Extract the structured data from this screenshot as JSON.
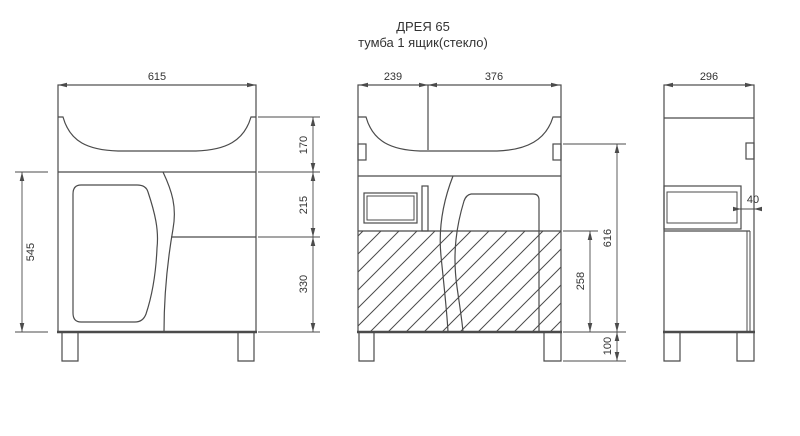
{
  "title": "ДРЕЯ 65",
  "subtitle": "тумба 1 ящик(стекло)",
  "colors": {
    "line": "#4b4b4b",
    "text": "#333333",
    "background": "#ffffff"
  },
  "dims": {
    "front": {
      "width": "615",
      "body_height": "545",
      "sink_zone": "170",
      "drawer_zone": "215",
      "niche_zone": "330"
    },
    "section": {
      "drawer_width": "239",
      "door_width": "376",
      "body_height": "616",
      "niche_height": "258",
      "leg_height": "100"
    },
    "side": {
      "depth": "296",
      "front_gap": "40"
    }
  }
}
